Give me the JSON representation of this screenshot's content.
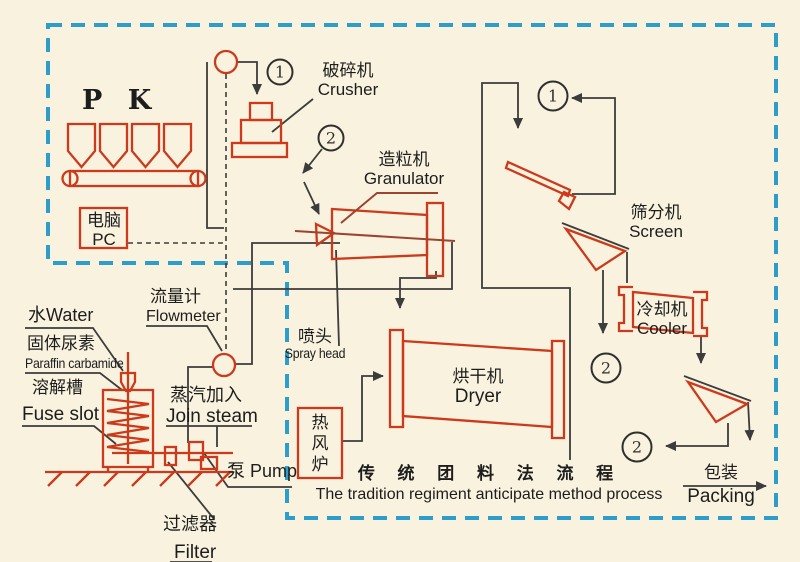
{
  "colors": {
    "background": "#f8f2df",
    "border_dash": "#2d9ec9",
    "equipment_red": "#cc3a1b",
    "equipment_dark_red": "#9c4430",
    "flow_line": "#3c3c3c",
    "text": "#1d1d1d"
  },
  "feed": {
    "label": "P K"
  },
  "control": {
    "zh": "电脑",
    "en": "PC"
  },
  "stations": {
    "crusher": {
      "zh": "破碎机",
      "en": "Crusher"
    },
    "granulator": {
      "zh": "造粒机",
      "en": "Granulator"
    },
    "screen": {
      "zh": "筛分机",
      "en": "Screen"
    },
    "cooler": {
      "zh": "冷却机",
      "en": "Cooler"
    },
    "dryer": {
      "zh": "烘干机",
      "en": "Dryer"
    },
    "spray_head": {
      "zh": "喷头",
      "en": "Spray head"
    },
    "hot_air_furnace": {
      "zh": "热风炉"
    },
    "packing": {
      "zh": "包装",
      "en": "Packing"
    }
  },
  "solution_prep": {
    "water": {
      "label": "水Water"
    },
    "solid_urea": {
      "zh": "固体尿素",
      "en": "Paraffin carbamide"
    },
    "fuse_slot": {
      "zh": "溶解槽",
      "en": "Fuse slot"
    },
    "flowmeter": {
      "zh": "流量计",
      "en": "Flowmeter"
    },
    "join_steam": {
      "zh": "蒸汽加入",
      "en": "Join steam"
    },
    "pump": {
      "label": "泵 Pump"
    },
    "filter": {
      "zh": "过滤器",
      "en": "Filter"
    }
  },
  "caption": {
    "zh": "传 统 团 料 法 流 程",
    "en": "The tradition regiment anticipate method process"
  },
  "connectors": {
    "one": "1",
    "two": "2"
  }
}
